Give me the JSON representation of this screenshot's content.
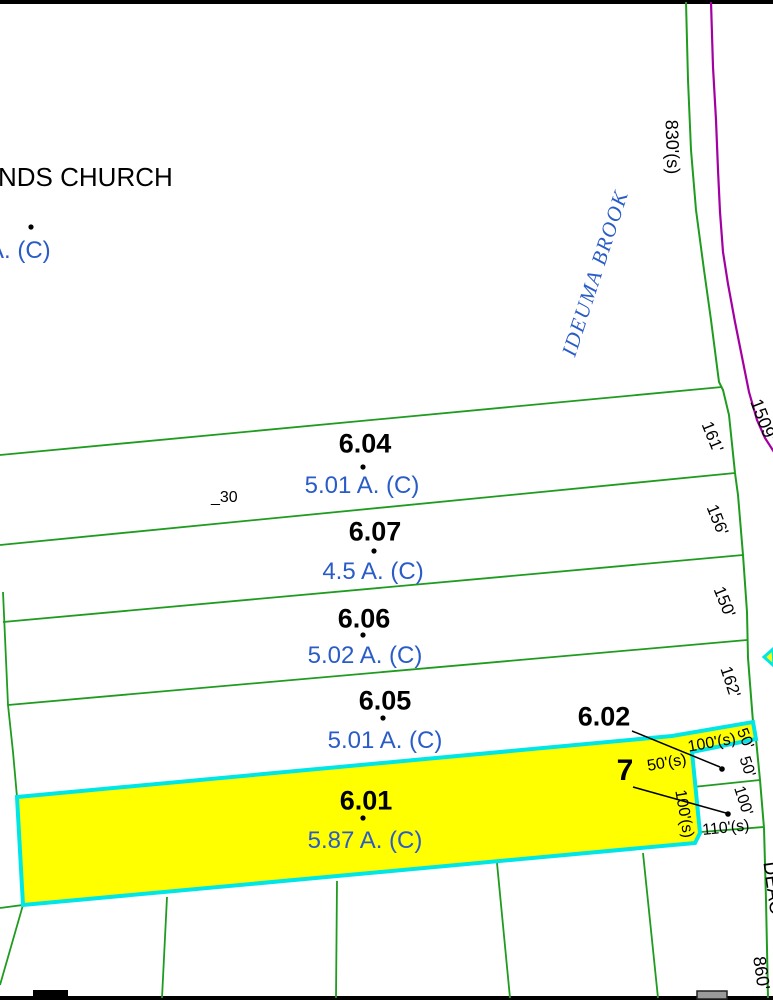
{
  "map": {
    "church_label_partial": "NDS CHURCH",
    "church_acreage_partial": "A. (C)",
    "brook_label": "IDEUMA BROOK",
    "small_annotation": "_30",
    "road_name_partial": "DEAC",
    "parcels": [
      {
        "id": "6.04",
        "acreage": "5.01 A. (C)"
      },
      {
        "id": "6.07",
        "acreage": "4.5 A. (C)"
      },
      {
        "id": "6.06",
        "acreage": "5.02 A. (C)"
      },
      {
        "id": "6.05",
        "acreage": "5.01 A. (C)"
      },
      {
        "id": "6.01",
        "acreage": "5.87 A. (C)",
        "highlighted": true
      },
      {
        "id": "6.02"
      },
      {
        "id": "7"
      }
    ],
    "dimensions": {
      "church_east": "830'(s)",
      "road": "1509'",
      "lot604_east": "161'",
      "lot607_east": "156'",
      "lot606_east": "150'",
      "lot605_east": "162'",
      "strip_north": "100'(s)",
      "strip_east": "50'",
      "strip_south": "50'(s)",
      "small_lot_a_east": "50'",
      "small_lot_b_east": "100'",
      "lot601_notch_east": "100'(s)",
      "small_lot_b_south": "110'(s)",
      "south_line": "860'"
    },
    "colors": {
      "parcel_line": "#1f9c1f",
      "road_line": "#a300a3",
      "highlight_border": "#00e6e6",
      "highlight_fill": "#ffff00",
      "acreage_text": "#2a5cc8",
      "brook_text": "#2a5cc8",
      "dimension_text": "#000000"
    }
  }
}
